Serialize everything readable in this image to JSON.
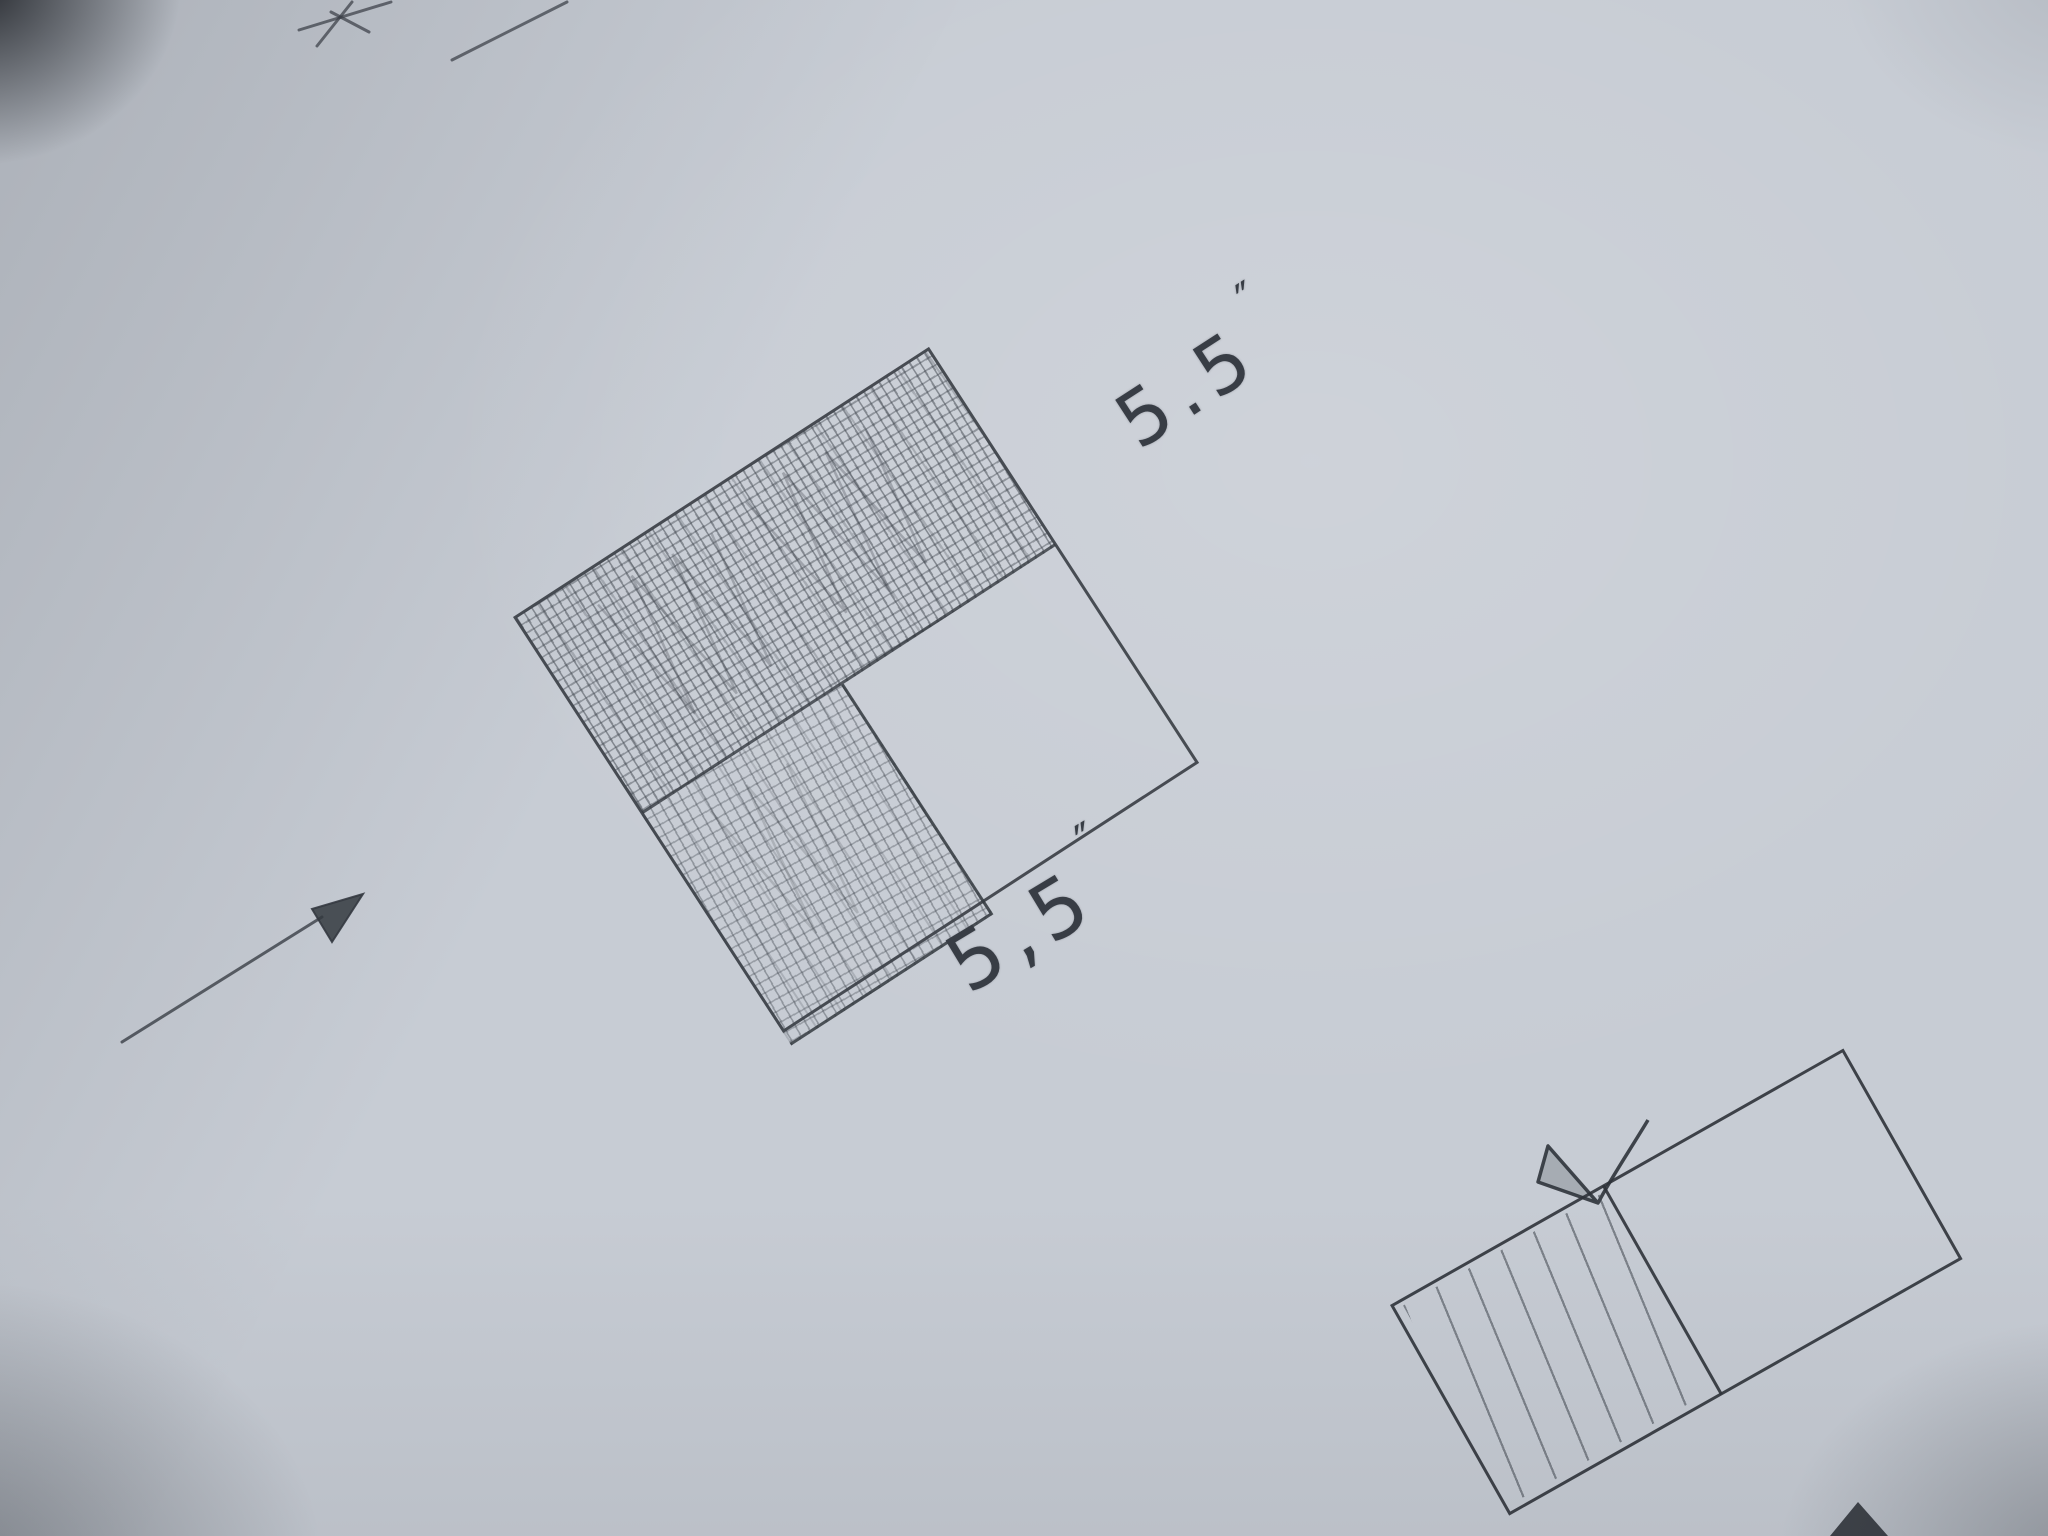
{
  "scene": {
    "kind": "photographed pencil sketch on gray-blue paper",
    "palette": {
      "paper": "#c7ccd4",
      "pencil_outline": "#343940",
      "pencil_hatch": "#3c424a",
      "corner_shadow": "#16191e"
    }
  },
  "main_figure": {
    "name": "tilted square, top band cross-hatched, lower-left inner square cross-hatched, lower-right empty",
    "dimension_top": {
      "value": "5.5",
      "unit": "″"
    },
    "dimension_bottom": {
      "value": "5,5",
      "unit": "″"
    }
  },
  "secondary_figure": {
    "name": "tilted rectangle at photo edge, left half line-hatched, right half empty, bowtie pinch mark on top edge"
  },
  "annotations": {
    "arrow": "pencil arrow pointing toward main square",
    "corner_marks": "cut-off pencil strokes of another sketch at top-left",
    "edge_wedge": "cut-off dark pencil tip at bottom edge"
  }
}
